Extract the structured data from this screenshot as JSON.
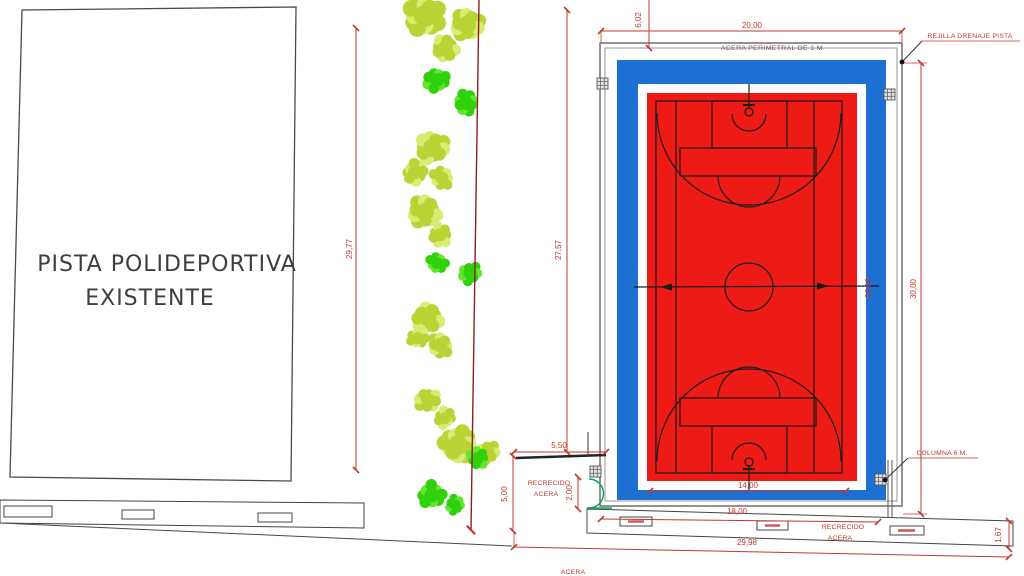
{
  "plan": {
    "existing_court": {
      "line1": "PISTA POLIDEPORTIVA",
      "line2": "EXISTENTE"
    },
    "annotations": {
      "acera_perimetral": "ACERA PERIMETRAL DE 1 M.",
      "rejilla_drenaje": "REJILLA DRENAJE PISTA",
      "columna": "COLUMNA 6 M.",
      "recrecido_left": {
        "line1": "RECRECIDO",
        "line2": "ACERA"
      },
      "recrecido_right": {
        "line1": "RECRECIDO",
        "line2": "ACERA"
      },
      "acera_street": "ACERA"
    },
    "dimensions": {
      "top_width": "20,00",
      "top_offset": "6,02",
      "existing_height": "29,77",
      "new_court_left_height": "27,57",
      "enclosure_height": "30,00",
      "court_length": "26,00",
      "court_width": "14,00",
      "walk_bottom": "18,00",
      "total_width": "29,98",
      "walk_right": "1,67",
      "recrecido_width": "5,50",
      "recrecido_height": "5,00",
      "gate_height": "2,00"
    },
    "colors": {
      "court_red": "#ee1a15",
      "court_blue": "#1e6fd2",
      "dimension_red": "#c0392b",
      "tree_green": "#2fd10c",
      "tree_green_light": "#63e52e",
      "tree_yellow": "#b9d434",
      "tree_yellow_light": "#d6ec73",
      "gate_green": "#00a651"
    }
  }
}
